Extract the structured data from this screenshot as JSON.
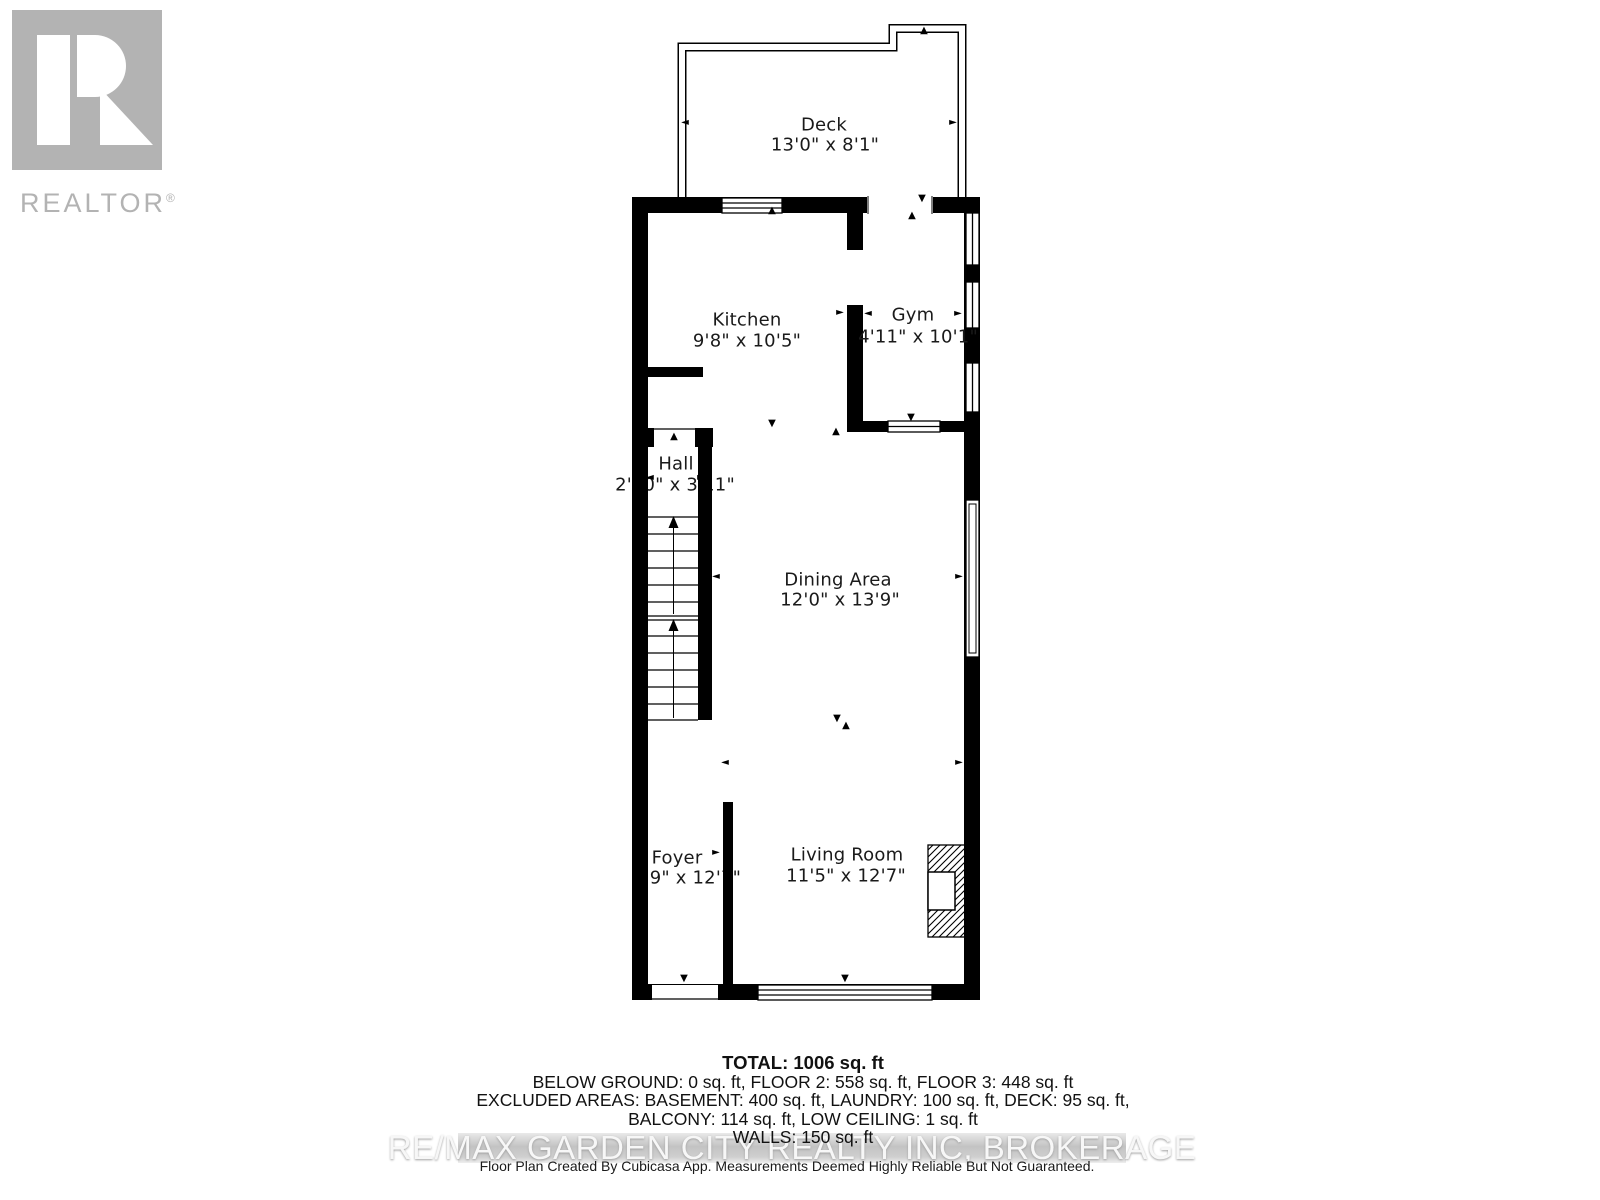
{
  "logo": {
    "brand": "REALTOR",
    "registered": "®"
  },
  "rooms": {
    "deck": {
      "name": "Deck",
      "dims": "13'0\" x 8'1\""
    },
    "kitchen": {
      "name": "Kitchen",
      "dims": "9'8\" x 10'5\""
    },
    "gym": {
      "name": "Gym",
      "dims": "4'11\" x 10'1\""
    },
    "hall": {
      "name": "Hall",
      "dims": "2'10\" x 3'11\""
    },
    "dining": {
      "name": "Dining Area",
      "dims": "12'0\" x 13'9\""
    },
    "foyer": {
      "name": "Foyer",
      "dims": "3'9\" x 12'7\""
    },
    "living": {
      "name": "Living Room",
      "dims": "11'5\" x 12'7\""
    }
  },
  "summary": {
    "total": "TOTAL: 1006 sq. ft",
    "floors": "BELOW GROUND: 0 sq. ft, FLOOR 2: 558 sq. ft, FLOOR 3: 448 sq. ft",
    "excluded1": "EXCLUDED AREAS: BASEMENT: 400 sq. ft, LAUNDRY: 100 sq. ft, DECK: 95 sq. ft,",
    "excluded2": "BALCONY: 114 sq. ft, LOW CEILING: 1 sq. ft",
    "walls": "WALLS: 150 sq. ft"
  },
  "watermark": "RE/MAX GARDEN CITY REALTY INC, BROKERAGE",
  "footer": "Floor Plan Created By Cubicasa App. Measurements Deemed Highly Reliable But Not Guaranteed.",
  "glyphs": {
    "up": "▲",
    "down": "▼",
    "left": "◄",
    "right": "►"
  },
  "colors": {
    "wall": "#000000",
    "logo_gray": "#b3b3b3",
    "watermark_band": "#c3c3c3",
    "watermark_text": "#f7f7f7"
  }
}
